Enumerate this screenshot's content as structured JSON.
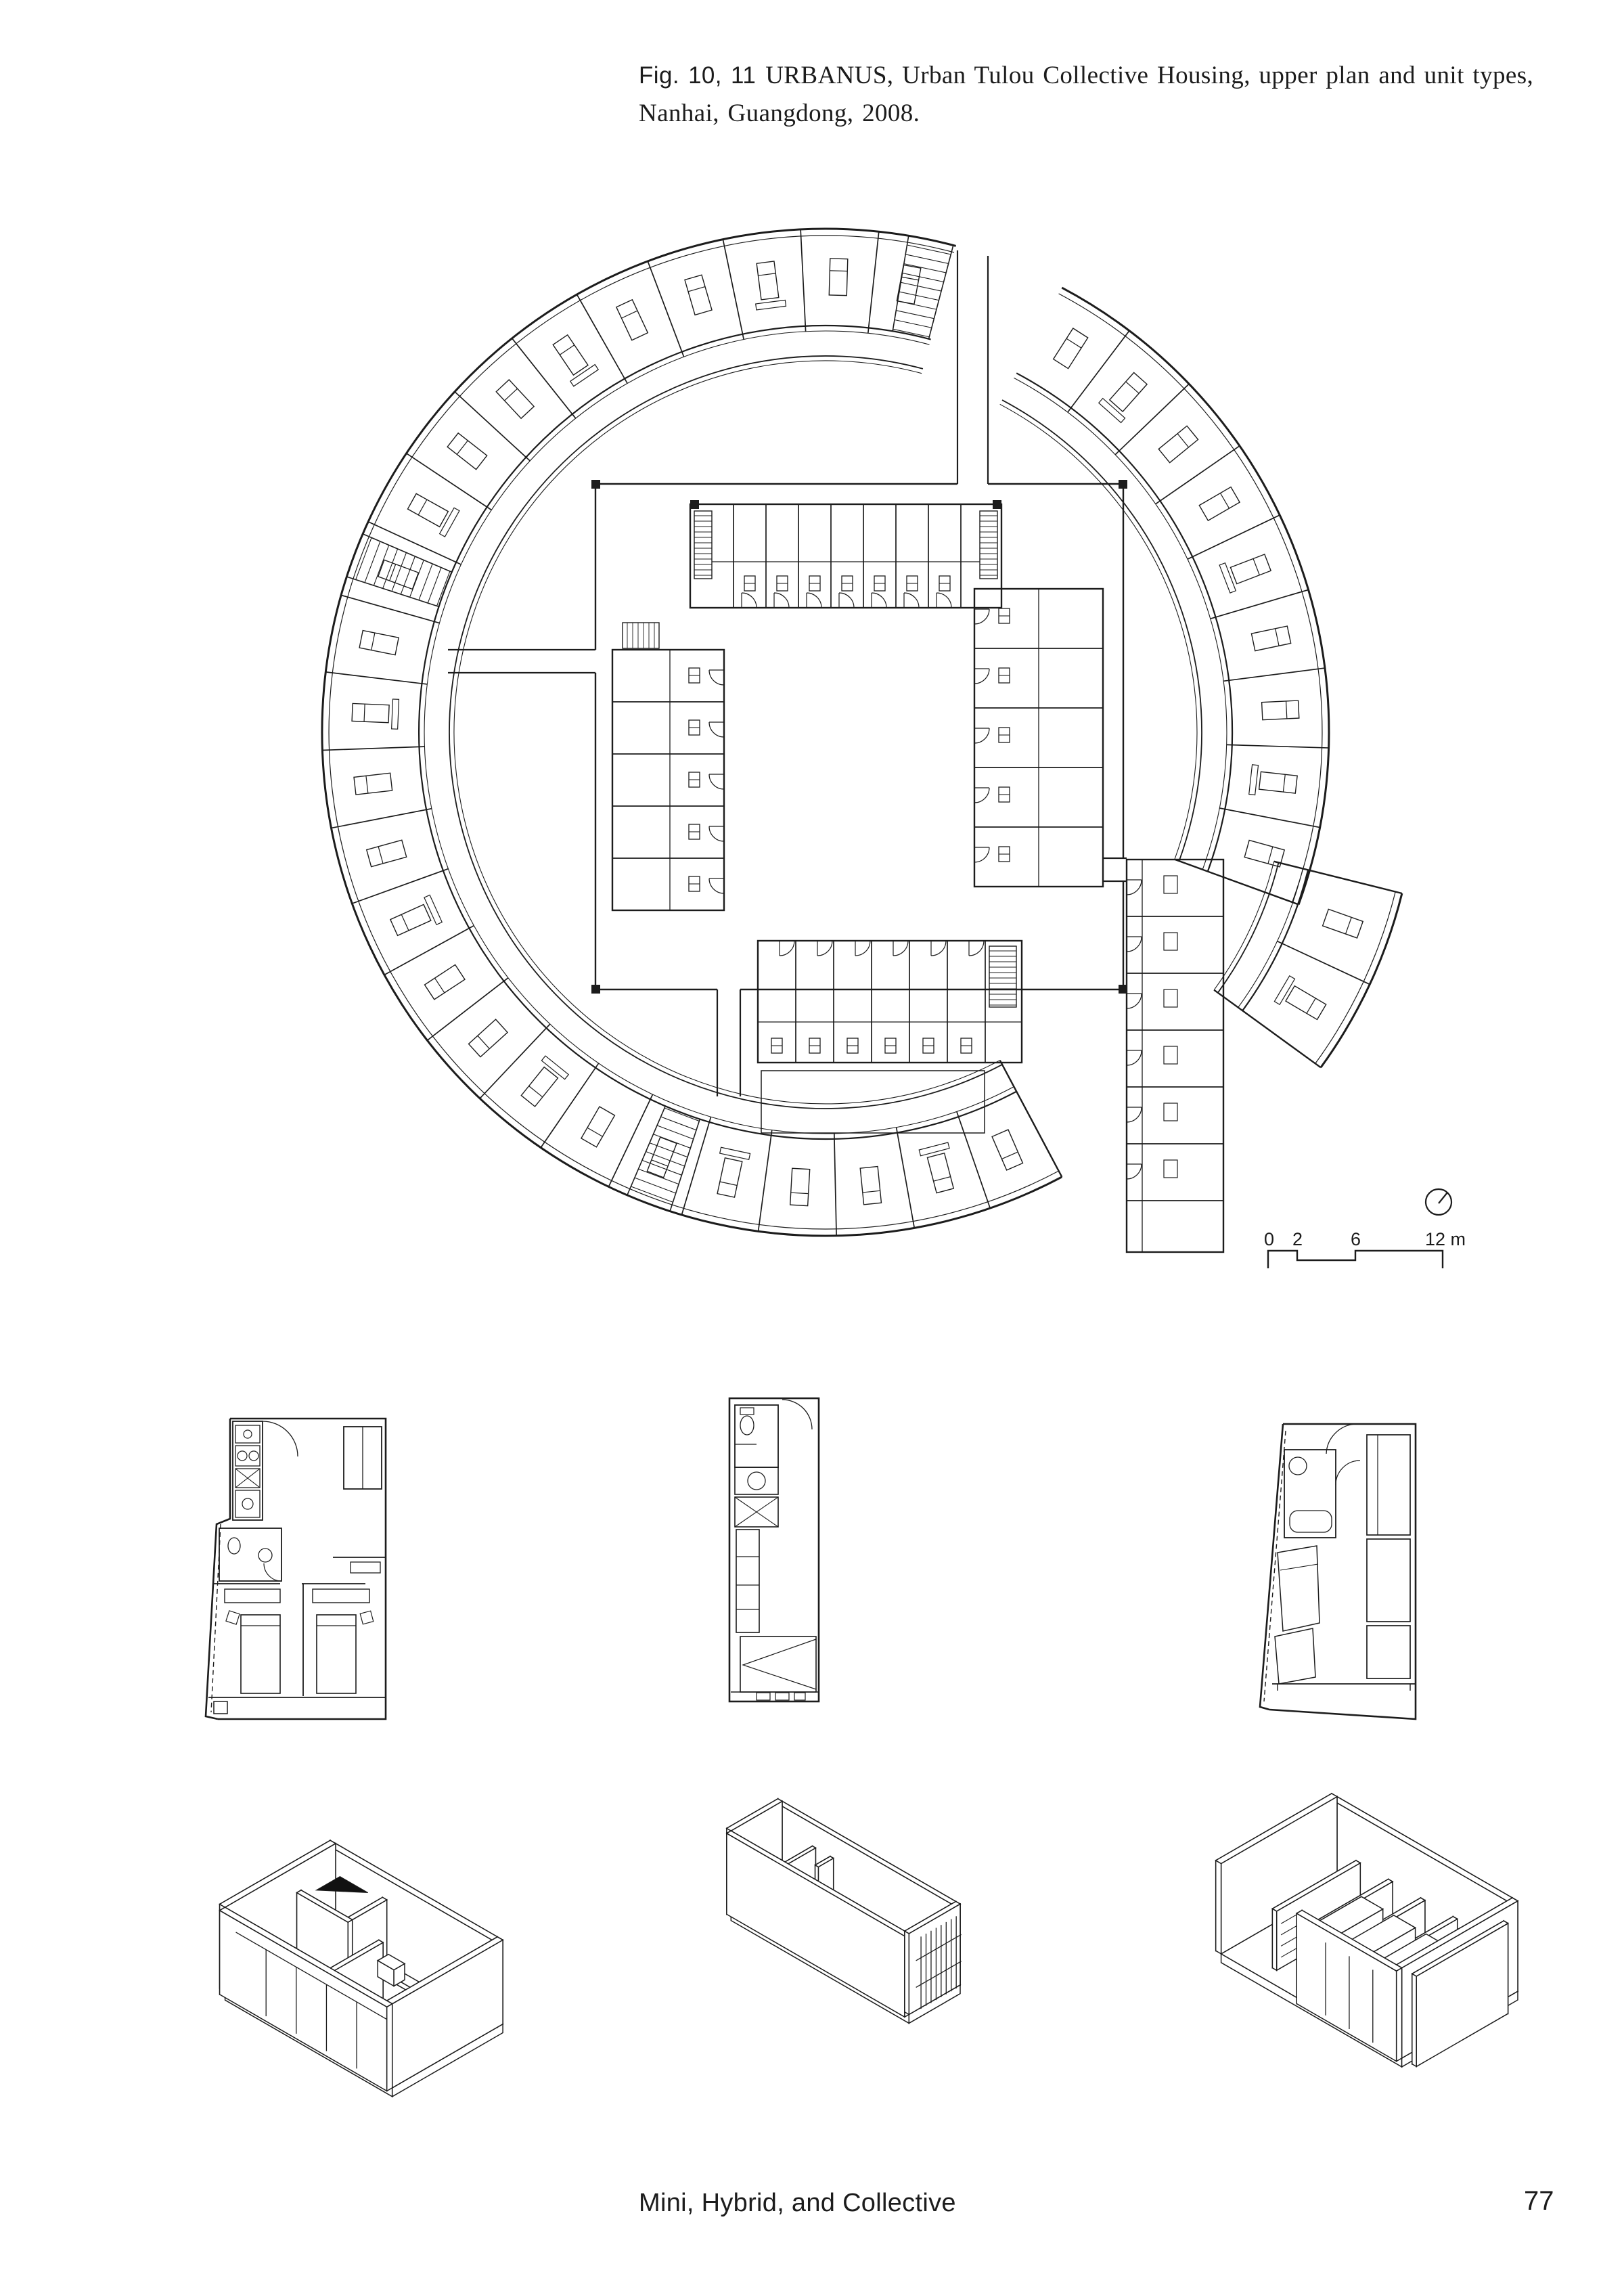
{
  "page": {
    "background": "#ffffff",
    "ink": "#1c1c1c"
  },
  "caption": {
    "fig_label": "Fig. 10, 11",
    "line1": "URBANUS, Urban Tulou Collective Housing, upper plan and unit types,",
    "line2": "Nanhai, Guangdong, 2008."
  },
  "scale_bar": {
    "labels": [
      "0",
      "2",
      "6",
      "12 m"
    ]
  },
  "footer": {
    "section_title": "Mini, Hybrid, and Collective",
    "page_number": "77"
  }
}
